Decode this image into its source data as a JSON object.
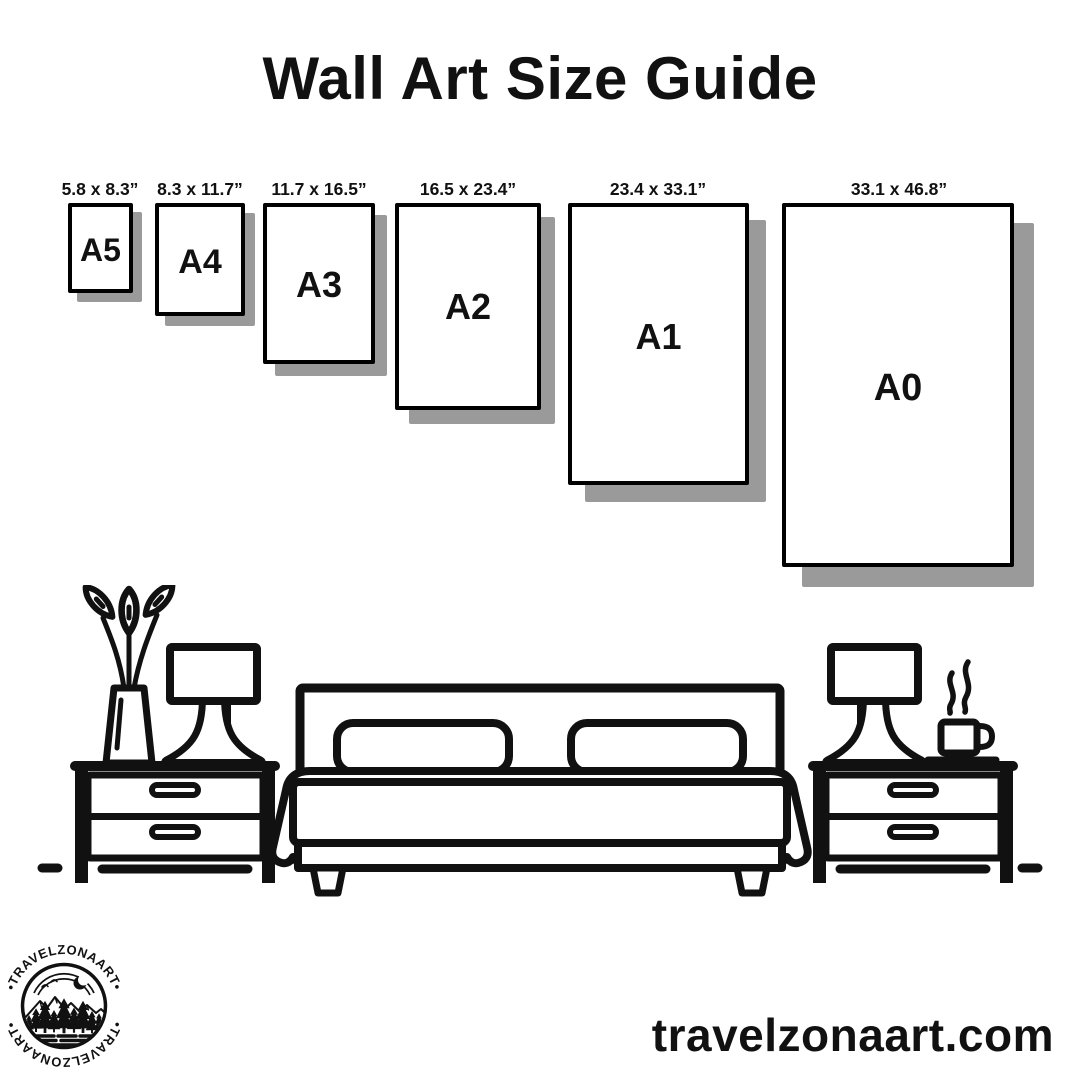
{
  "title": "Wall Art Size Guide",
  "sizes": [
    {
      "name": "A5",
      "dimensions": "5.8 x 8.3”"
    },
    {
      "name": "A4",
      "dimensions": "8.3 x 11.7”"
    },
    {
      "name": "A3",
      "dimensions": "11.7 x 16.5”"
    },
    {
      "name": "A2",
      "dimensions": "16.5 x 23.4”"
    },
    {
      "name": "A1",
      "dimensions": "23.4 x 33.1”"
    },
    {
      "name": "A0",
      "dimensions": "33.1 x 46.8”"
    }
  ],
  "logo": {
    "arc_text_top": "•TRAVELZONAART•",
    "arc_text_bottom": "•TRAVELZONAART•"
  },
  "footer": {
    "website": "travelzonaart.com"
  },
  "colors": {
    "ink": "#111111",
    "shadow": "#9a9a9a",
    "background": "#ffffff"
  },
  "scene_icons": [
    "flower-vase-icon",
    "table-lamp-icon",
    "nightstand-icon",
    "double-bed-icon",
    "pillow-icon",
    "coffee-cup-icon",
    "steam-icon",
    "floor-line-icon",
    "mountain-badge-logo-icon"
  ]
}
